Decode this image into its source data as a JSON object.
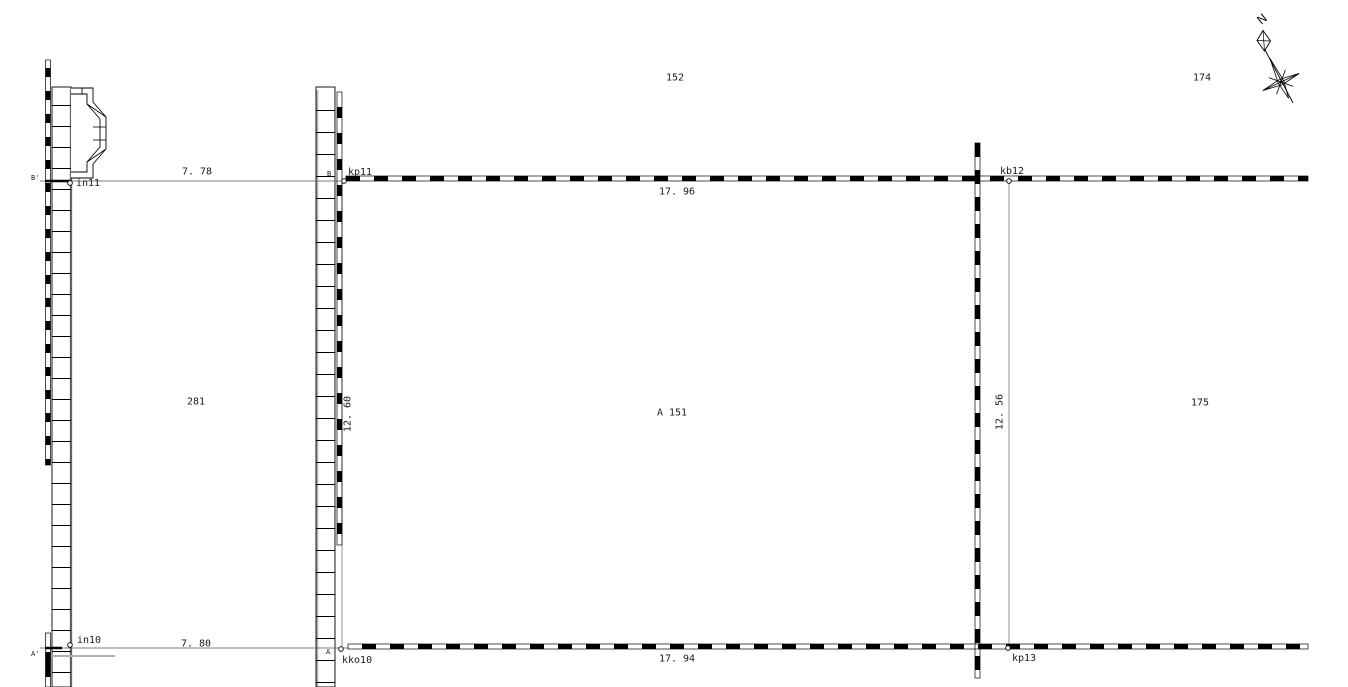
{
  "parcels": {
    "p152": "152",
    "p174": "174",
    "p281": "281",
    "a151": "A 151",
    "p175": "175"
  },
  "points": {
    "in11": "in11",
    "kp11": "kp11",
    "kb12": "kb12",
    "in10": "in10",
    "kko10": "kko10",
    "kp13": "kp13"
  },
  "dimensions": {
    "top_left": "7. 78",
    "top": "17. 96",
    "left_vertical": "12. 60",
    "right_vertical": "12. 56",
    "bottom_left": "7. 80",
    "bottom": "17. 94"
  },
  "sections": {
    "b_prime": "B'",
    "b": "B",
    "a_prime": "A'",
    "a": "A"
  },
  "compass": {
    "north": "N"
  },
  "colors": {
    "line": "#000000",
    "aux_line": "#777777",
    "rail_gray": "#b3b3b3",
    "text": "#1a1a1a",
    "background": "#ffffff"
  }
}
